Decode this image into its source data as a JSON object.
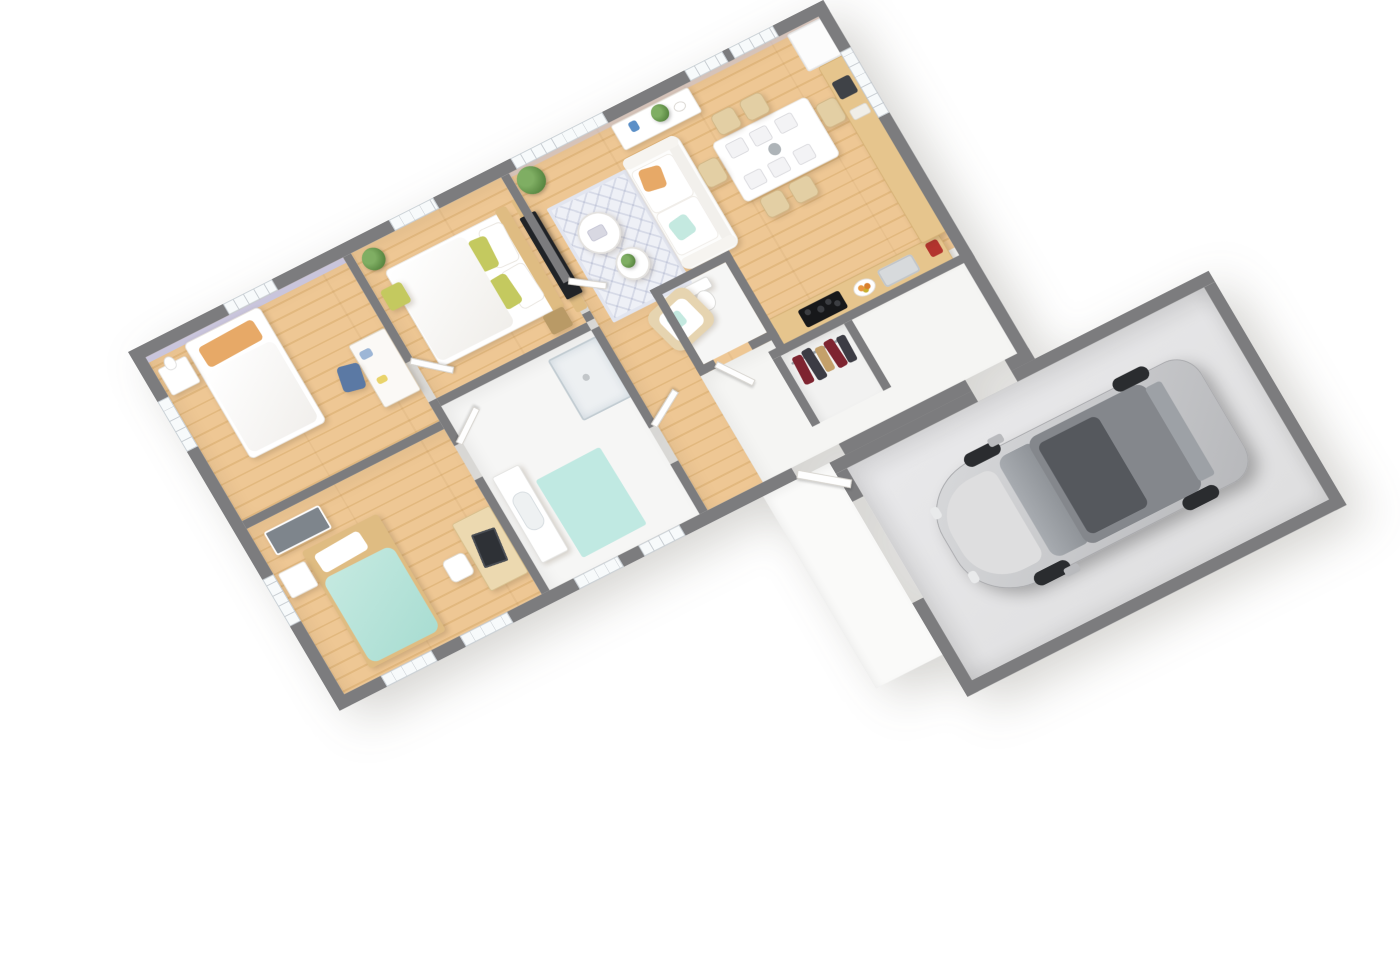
{
  "scene": {
    "title": "Isometric 3D floor plan of a single-storey house with attached garage",
    "view": "isometric top-down 3D render",
    "background": "#ffffff"
  },
  "palette": {
    "wallTop": "#7c7c7e",
    "wood1": "#eec794",
    "wood2": "#e2b87e",
    "whiteFloor": "#f5f5f3",
    "garageFloor": "#e4e4e6",
    "porch": "#fafaf9",
    "lavender": "#c9c5dc",
    "teal": "#c4e9e0",
    "matTeal": "#c0e9e2",
    "orange": "#e7a967",
    "olive": "#c4c95f",
    "woodFurn": "#dfbc82",
    "blue": "#5b79a4",
    "tvBlack": "#202327",
    "carBody": "#c7c8ca",
    "carGlass": "#84878c",
    "clothes1": "#7e2430",
    "clothes2": "#3c3c44",
    "clothes3": "#c4a06a",
    "plant": "#6fa257",
    "counterTop": "#e6c58d",
    "cooktop": "#17181a",
    "sinkGray": "#d7dadc",
    "rugBase": "#eef0f6"
  },
  "rooms": {
    "bedroom1": {
      "label": "Bedroom 1 — single bed, orange pillow, desk with blue chair, lavender wall"
    },
    "bedroom2": {
      "label": "Bedroom 2 — single bed with mint-teal duvet, desk with laptop"
    },
    "master": {
      "label": "Master bedroom — double bed, olive pillows, wood headboard wall with TV"
    },
    "bathroom": {
      "label": "Bathroom — vanity, teal bath mat, corner shower"
    },
    "wc": {
      "label": "Separate WC with toilet"
    },
    "hallway": {
      "label": "Hallway to bedrooms and bathroom"
    },
    "living": {
      "label": "Open living / dining room with sofa, rug and dining table"
    },
    "kitchen": {
      "label": "Kitchen — wood countertops, cooktop, sink, fridge"
    },
    "entry": {
      "label": "Entry corridor"
    },
    "closet": {
      "label": "Open wardrobe with hanging clothes"
    },
    "garage": {
      "label": "Garage with silver minivan"
    },
    "porch": {
      "label": "White entry slab / driveway"
    }
  },
  "furniture": {
    "bed1": "single bed",
    "bed2": "single bed teal",
    "masterBed": "double bed",
    "sofa": "white two-seat sofa",
    "armchair": "rattan armchair",
    "diningTable": "dining table for six",
    "sideboard": "sideboard with plant",
    "tv": "wall-mounted TV",
    "car": "silver minivan",
    "shower": "walk-in shower",
    "toilet": "toilet",
    "vanity": "washbasin vanity",
    "fridge": "refrigerator",
    "cooktop": "black induction cooktop",
    "sink": "kitchen sink"
  }
}
